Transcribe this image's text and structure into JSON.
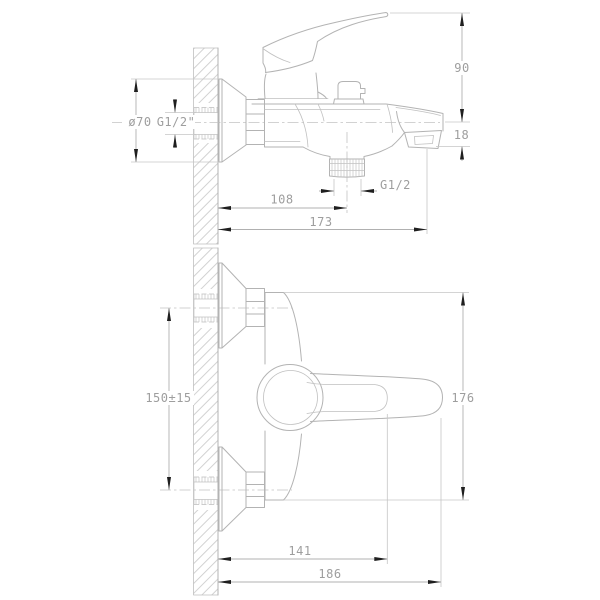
{
  "drawing": {
    "background": "#ffffff",
    "line_color": "#b3b3b3",
    "hatch_color": "#cccccc",
    "text_color": "#9e9e9e",
    "arrow_color": "#1f1f1f",
    "side_view": {
      "dim_escutcheon_diameter": "ø70",
      "dim_inlet_thread": "G1/2\"",
      "dim_handle_height": "90",
      "dim_spout_drop": "18",
      "dim_shower_outlet_thread": "G1/2",
      "dim_wall_to_outlet": "108",
      "dim_wall_to_spout_tip": "173"
    },
    "top_view": {
      "dim_connection_spacing": "150±15",
      "dim_body_width": "176",
      "dim_wall_to_lever_inner": "141",
      "dim_wall_to_lever_end": "186"
    }
  }
}
